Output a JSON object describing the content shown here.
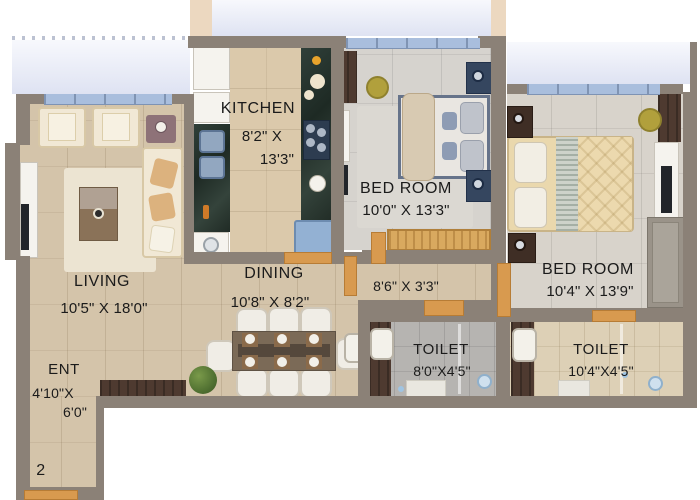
{
  "unit_number": "2",
  "rooms": {
    "kitchen": {
      "label": "KITCHEN",
      "dim_line1": "8'2\" X",
      "dim_line2": "13'3\""
    },
    "bedroom_1": {
      "label": "BED ROOM",
      "dim": "10'0\" X 13'3\""
    },
    "bedroom_2": {
      "label": "BED ROOM",
      "dim": "10'4\" X 13'9\""
    },
    "living": {
      "label": "LIVING",
      "dim": "10'5\" X 18'0\""
    },
    "dining": {
      "label": "DINING",
      "dim": "10'8\" X 8'2\""
    },
    "passage": {
      "dim": "8'6\" X 3'3\""
    },
    "toilet_1": {
      "label": "TOILET",
      "dim": "8'0\"X4'5\""
    },
    "toilet_2": {
      "label": "TOILET",
      "dim": "10'4\"X4'5\""
    },
    "entrance": {
      "label": "ENT",
      "dim_line1": "4'10\"X",
      "dim_line2": "6'0\""
    }
  },
  "colors": {
    "wall": "#8b8177",
    "door": "#d89a4f",
    "balcony": "#e9ecf8",
    "railing": "#a9bedd",
    "floor_beige": "#d4c4aa",
    "floor_kitchen": "#dbc9ab",
    "floor_bed1": "#d6d3ce",
    "floor_bed2": "#d8d3cb",
    "floor_toilet1": "#b6b4b1",
    "floor_toilet2": "#ddd0b6",
    "cream": "#f1e8d5",
    "white_furn": "#f5f3ee",
    "wood_dark": "#4e3a30",
    "rug": "#ece4d2",
    "text": "#1b1b1b"
  }
}
